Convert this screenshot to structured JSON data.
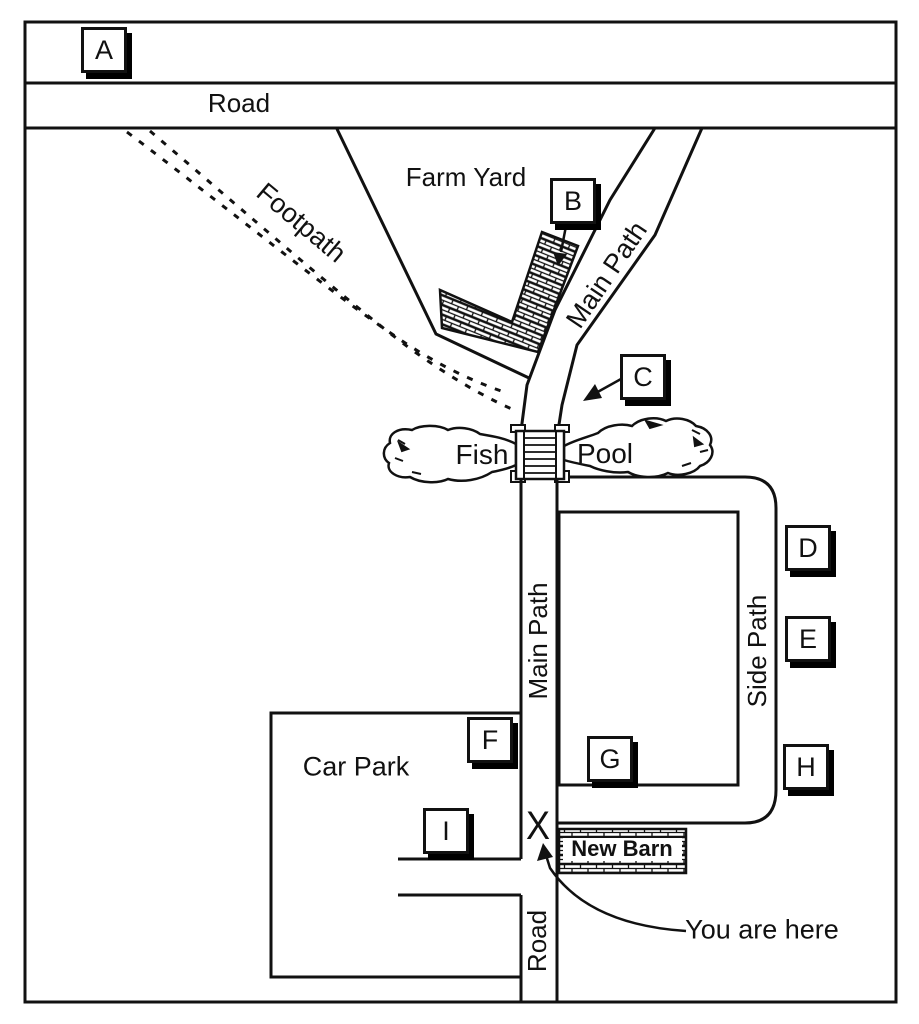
{
  "colors": {
    "ink": "#111111",
    "paper": "#ffffff"
  },
  "map": {
    "labels": {
      "road_top": "Road",
      "farm_yard": "Farm Yard",
      "footpath": "Footpath",
      "main_path_upper": "Main Path",
      "fish": "Fish",
      "pool": "Pool",
      "main_path_lower": "Main Path",
      "side_path": "Side Path",
      "car_park": "Car Park",
      "new_barn": "New Barn",
      "road_bottom": "Road",
      "you_are_here": "You are here"
    },
    "x_mark": "X",
    "markers": [
      "A",
      "B",
      "C",
      "D",
      "E",
      "F",
      "G",
      "H",
      "I"
    ]
  }
}
